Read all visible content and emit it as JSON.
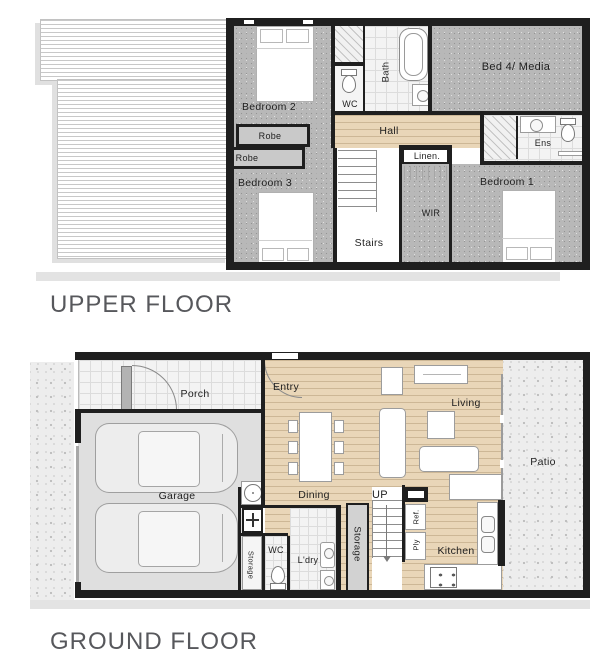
{
  "colors": {
    "wall": "#1f1f1f",
    "carpet": "#b8b8b8",
    "timber": "#e9d6b8",
    "tile": "#f3f3f3",
    "concrete": "#ededed",
    "garage": "#dfdfdf",
    "title-text": "#57585c",
    "label-text": "#1f1f1f"
  },
  "upper_floor": {
    "title": "UPPER FLOOR",
    "labels": {
      "bedroom2": "Bedroom 2",
      "robe2": "Robe",
      "robe3": "Robe",
      "bedroom3": "Bedroom 3",
      "wc": "WC",
      "bath": "Bath",
      "bed4_media": "Bed 4/ Media",
      "hall": "Hall",
      "linen": "Linen.",
      "ens": "Ens",
      "wir": "WIR",
      "bedroom1": "Bedroom 1",
      "stairs": "Stairs"
    }
  },
  "ground_floor": {
    "title": "GROUND FLOOR",
    "labels": {
      "porch": "Porch",
      "entry": "Entry",
      "living": "Living",
      "patio": "Patio",
      "garage": "Garage",
      "dining": "Dining",
      "up": "UP",
      "storage_left": "Storage",
      "wc": "WC",
      "laundry": "L'dry",
      "storage_mid": "Storage",
      "fridge": "Ref.",
      "pantry": "Ply",
      "kitchen": "Kitchen"
    }
  }
}
